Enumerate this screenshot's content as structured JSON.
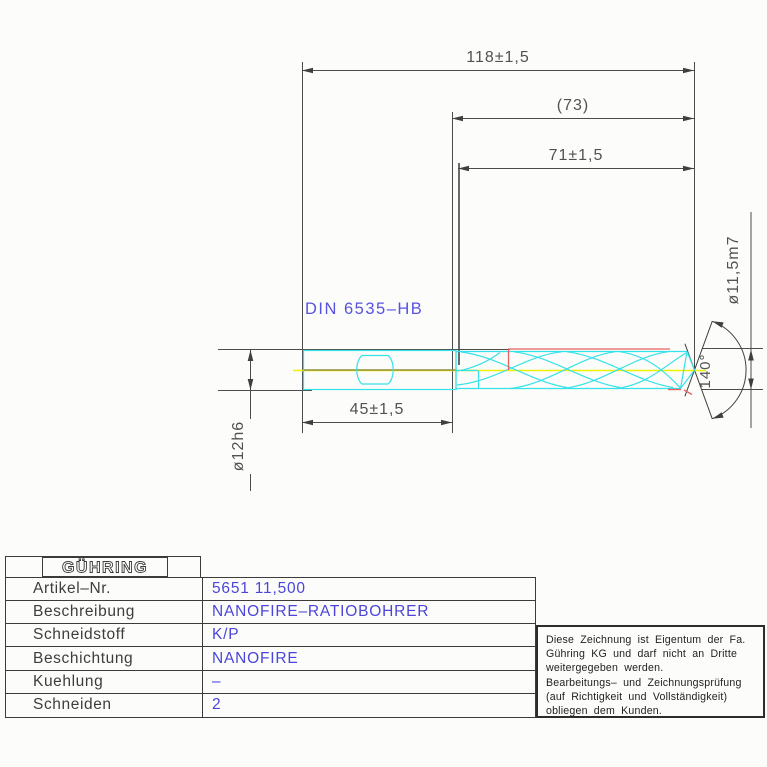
{
  "drawing": {
    "labels": {
      "overall_length": "118±1,5",
      "aux_length": "(73)",
      "flute_length": "71±1,5",
      "shank_length": "45±1,5",
      "shank_diameter": "ø12h6",
      "cutting_diameter": "ø11,5m7",
      "point_angle": "140°",
      "shank_standard": "DIN 6535–HB"
    },
    "colors": {
      "tool_outline": "#35e2e8",
      "centerline": "#f0f000",
      "highlight": "#e86060",
      "dimension_lines": "#4c4c4c",
      "label_blue": "#5752e0"
    }
  },
  "title_block": {
    "logo": "GÜHRING",
    "rows": [
      {
        "label": "Artikel–Nr.",
        "value": "5651 11,500"
      },
      {
        "label": "Beschreibung",
        "value": "NANOFIRE–RATIOBOHRER"
      },
      {
        "label": "Schneidstoff",
        "value": "K/P"
      },
      {
        "label": "Beschichtung",
        "value": "NANOFIRE"
      },
      {
        "label": "Kuehlung",
        "value": "–"
      },
      {
        "label": "Schneiden",
        "value": "2"
      }
    ]
  },
  "note": {
    "lines": [
      "Diese Zeichnung ist Eigentum der Fa.",
      "Gühring KG und darf nicht an Dritte",
      "weitergegeben werden.",
      "Bearbeitungs– und Zeichnungsprüfung",
      "(auf Richtigkeit und Vollständigkeit)",
      "obliegen dem Kunden."
    ]
  }
}
